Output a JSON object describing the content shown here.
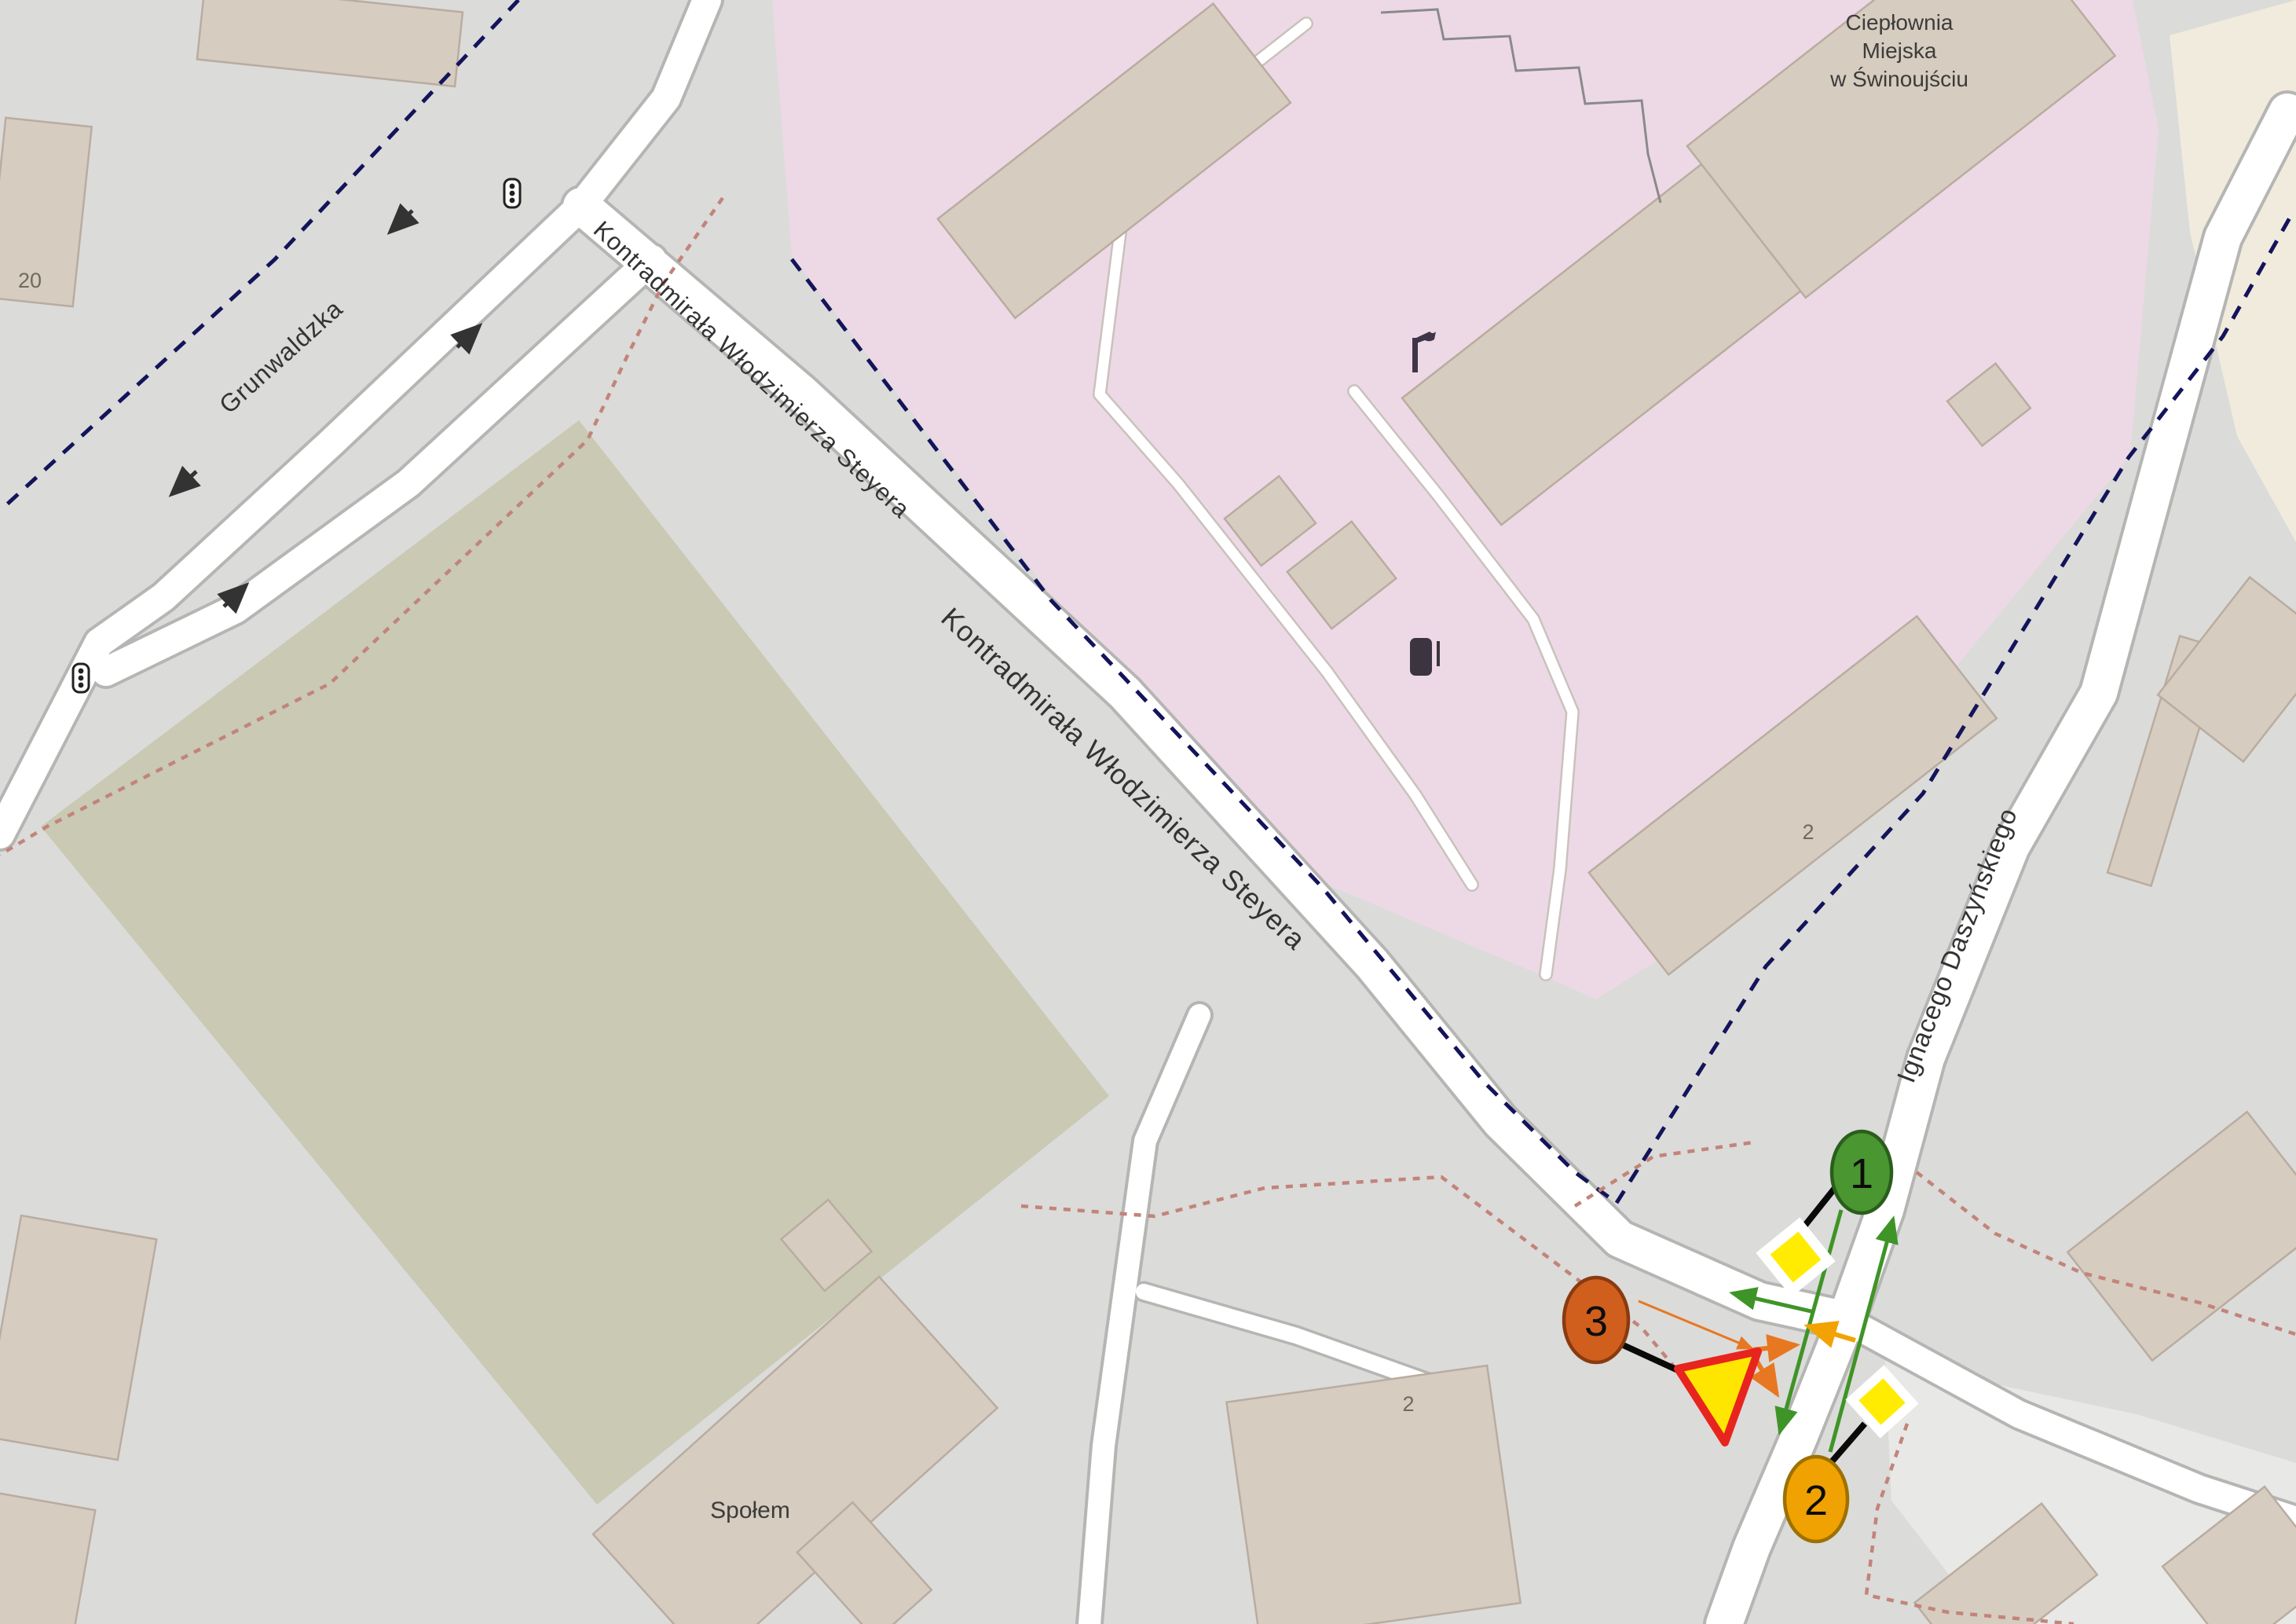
{
  "map": {
    "streets": {
      "grunwaldzka": "Grunwaldzka",
      "steyera_1": "Kontradmirała Włodzimierza Steyera",
      "steyera_2": "Kontradmirała Włodzimierza Steyera",
      "daszynskiego": "Ignacego Daszyńskiego"
    },
    "places": {
      "heating_plant_line1": "Ciepłownia",
      "heating_plant_line2": "Miejska",
      "heating_plant_line3": "w Świnoujściu",
      "store": "Społem"
    },
    "housenumbers": {
      "top_left": "20",
      "industrial": "2",
      "south": "2"
    },
    "colors": {
      "background": "#dbdbd9",
      "industrial_area": "#edd9e5",
      "green_area": "#c9c9b4",
      "cream_area": "#f0ebdd",
      "parking_area": "#e8e8e6",
      "building": "#d6ccbf",
      "building_outline": "#b9aca0",
      "road_fill": "#ffffff",
      "road_casing": "#b5b5b3",
      "boundary_dashed": "#14145a",
      "path_dotted": "#c2847a"
    }
  },
  "annotations": {
    "markers": [
      {
        "label": "1",
        "fill": "#4a9630",
        "stroke": "#2a5e1c"
      },
      {
        "label": "2",
        "fill": "#f0a202",
        "stroke": "#9c7100"
      },
      {
        "label": "3",
        "fill": "#d05f1e",
        "stroke": "#8a3a10"
      }
    ],
    "arrow_colors": {
      "green": "#3f9427",
      "orange": "#e87722",
      "amber": "#f2a202"
    },
    "sign_colors": {
      "triangle_fill": "#ffe600",
      "triangle_border": "#e8241e",
      "diamond_fill": "#ffec00",
      "diamond_border": "#ffffff"
    }
  }
}
